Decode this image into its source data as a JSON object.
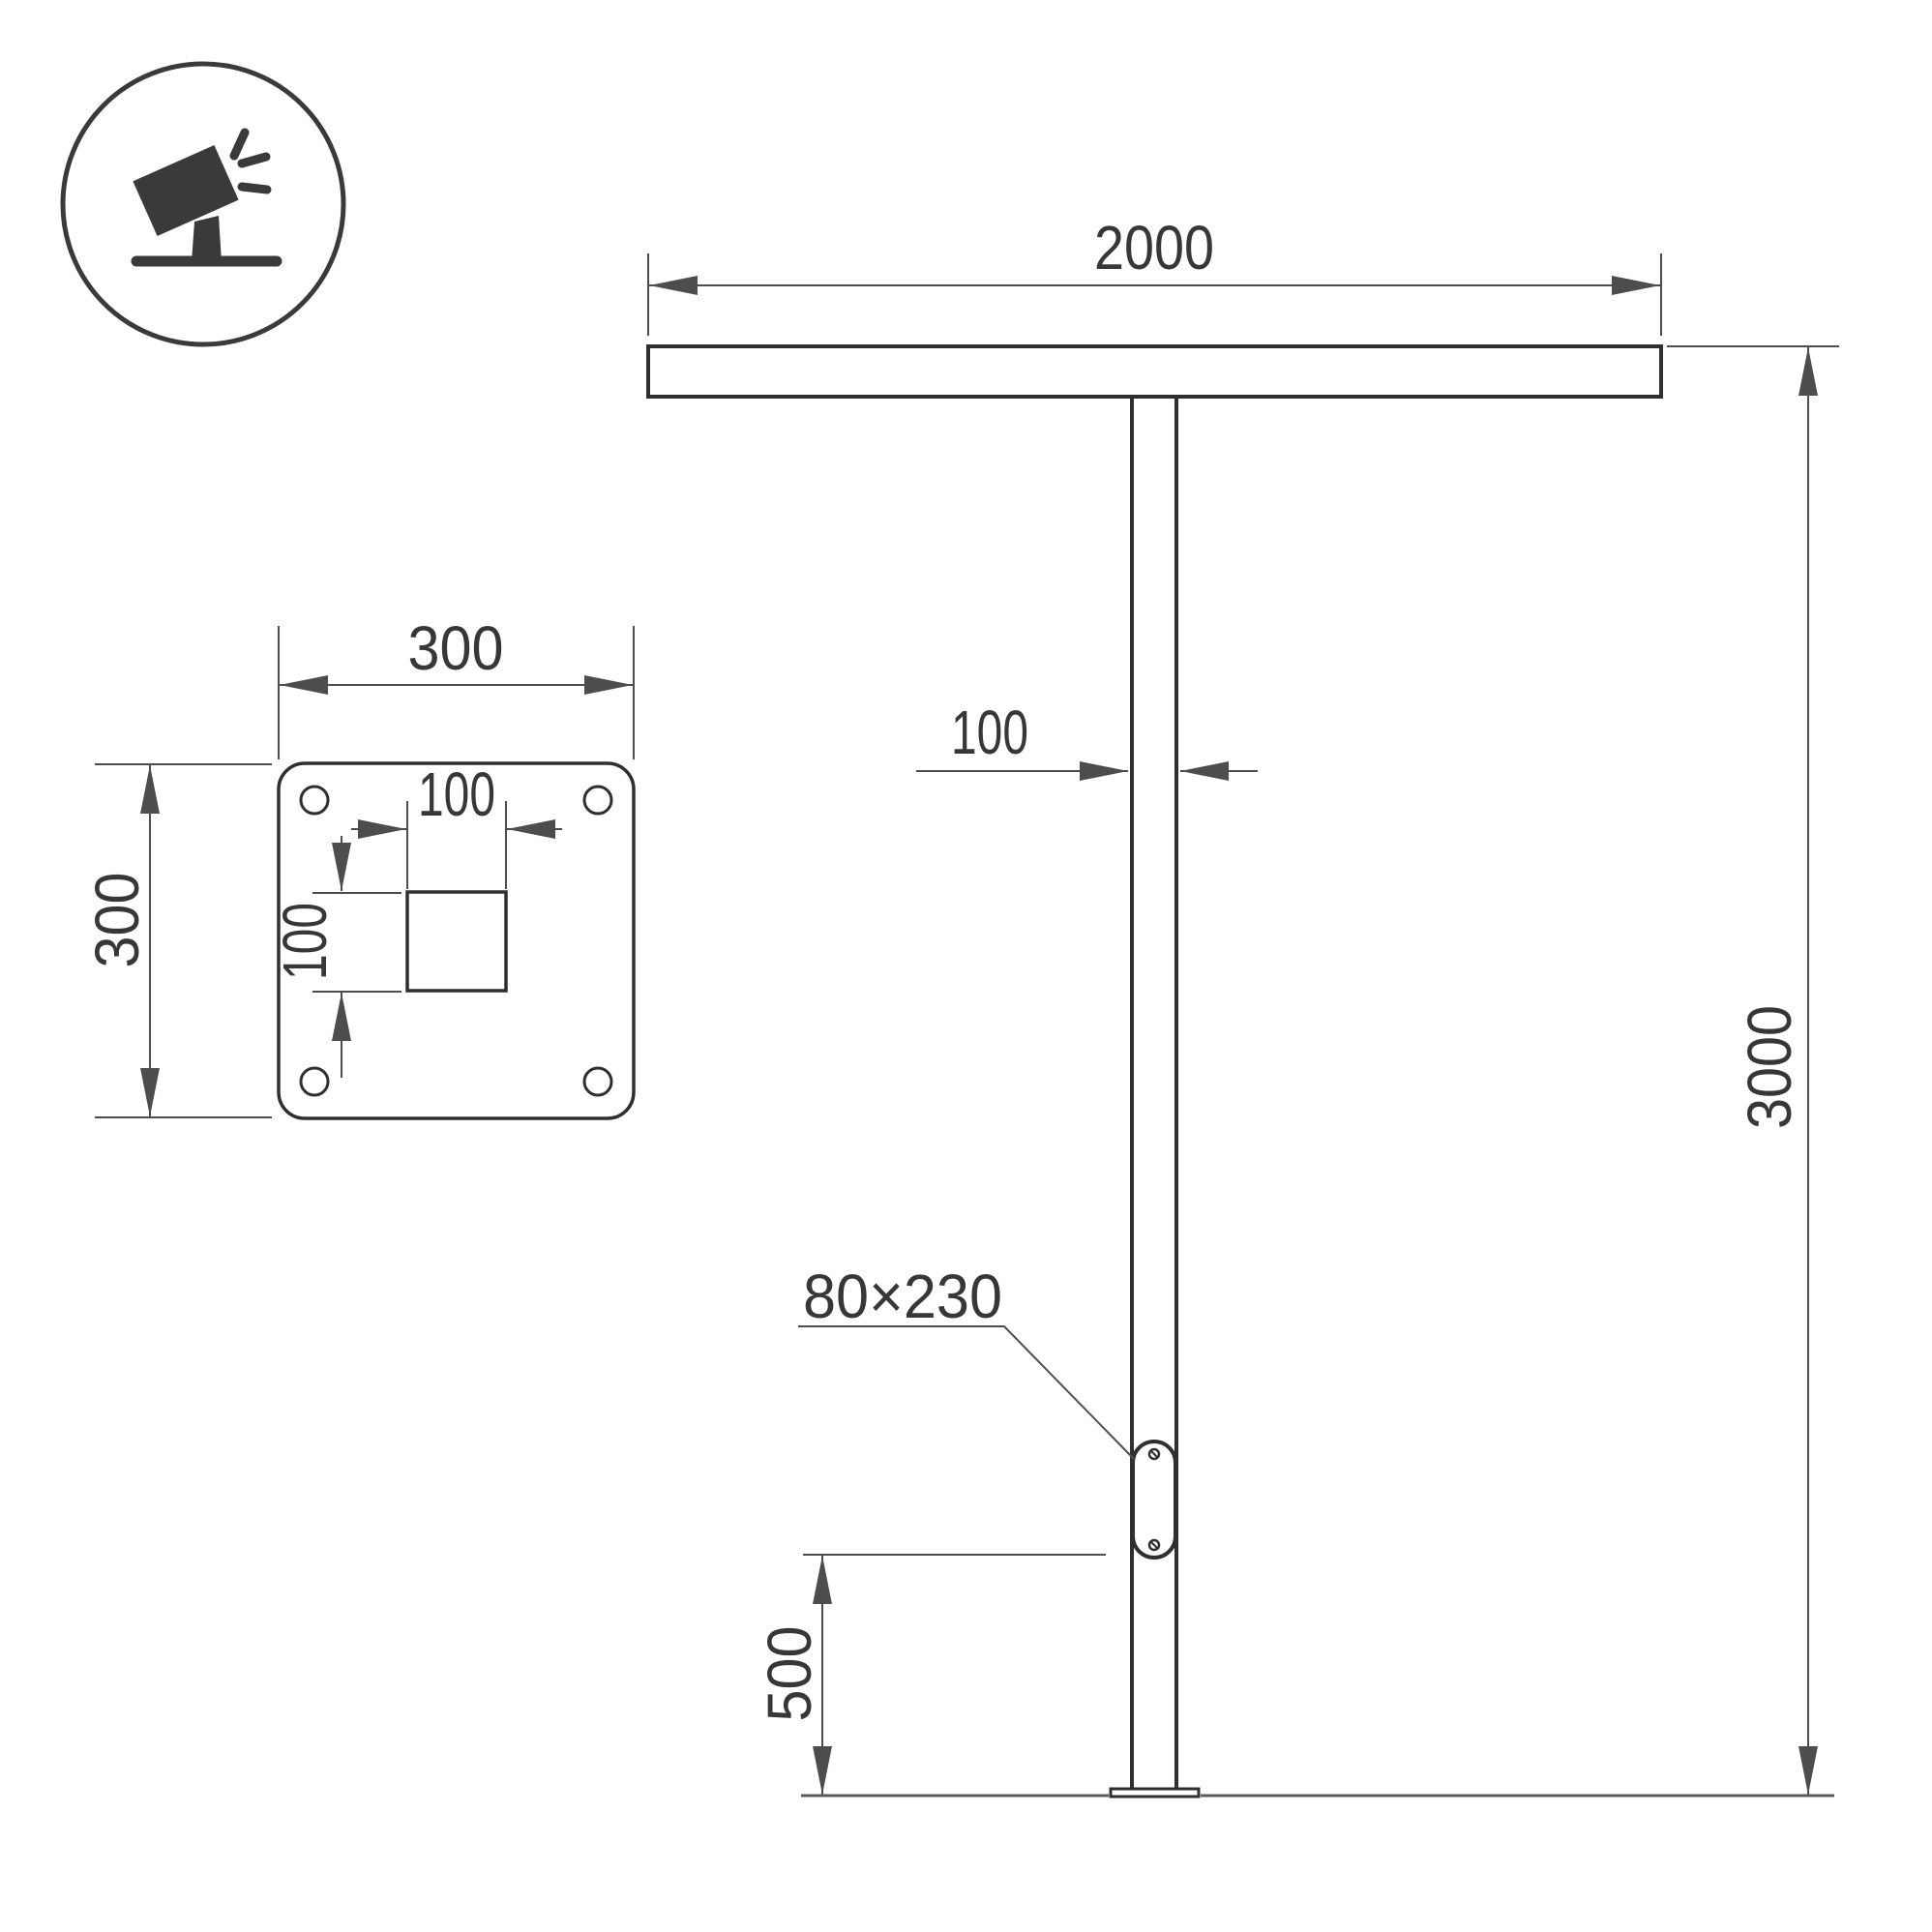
{
  "drawing": {
    "type": "street-light-pole-technical-drawing",
    "front_view": {
      "crossbar_width_label": "2000",
      "pole_width_label": "100",
      "total_height_label": "3000",
      "hatch_size_label": "80×230",
      "hatch_bottom_height_label": "500"
    },
    "plate_view": {
      "plate_width_label": "300",
      "plate_height_label": "300",
      "square_width_label": "100",
      "square_height_label": "100"
    },
    "icon": {
      "meaning": "tilted-floodlight-luminaire-on-stand"
    }
  },
  "colors": {
    "background": "#ffffff",
    "outline": "#2f2f2f",
    "dimension": "#4d4d4d",
    "ground": "#5a5a5a",
    "text": "#373737",
    "icon": "#3a3a3a"
  }
}
